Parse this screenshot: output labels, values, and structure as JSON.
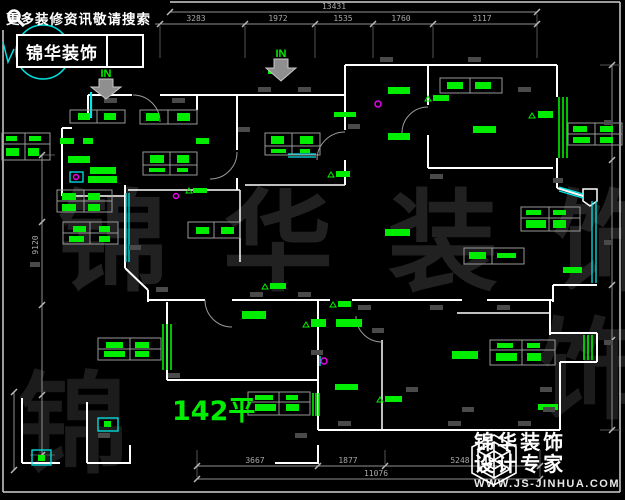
{
  "banner": {
    "tagline": "更多装修资讯敬请搜索",
    "brand": "锦华装饰",
    "search_icon": "magnifier-icon"
  },
  "watermark": {
    "text": "锦华装饰",
    "char_first": "锦",
    "char_last": "饰"
  },
  "plan": {
    "area_label": "142平",
    "entry_label": "IN",
    "colors": {
      "label_green": "#00ee00",
      "window_cyan": "#00e8e8",
      "wall_white": "#ffffff",
      "dimension_gray": "#a8a8a8",
      "accent_magenta": "#ee00ee"
    }
  },
  "dimensions": {
    "top": {
      "total": "13431",
      "segments": [
        "3283",
        "1972",
        "1535",
        "1760",
        "3117"
      ]
    },
    "bottom": {
      "total": "11076",
      "segments": [
        "3667",
        "1877",
        "5248"
      ]
    },
    "left": {
      "total": "9120"
    }
  },
  "logo": {
    "brand": "锦华装饰",
    "subtitle": "设计专家",
    "website": "WWW.JS-JINHUA.COM",
    "icon": "cube-hexagon-icon"
  }
}
